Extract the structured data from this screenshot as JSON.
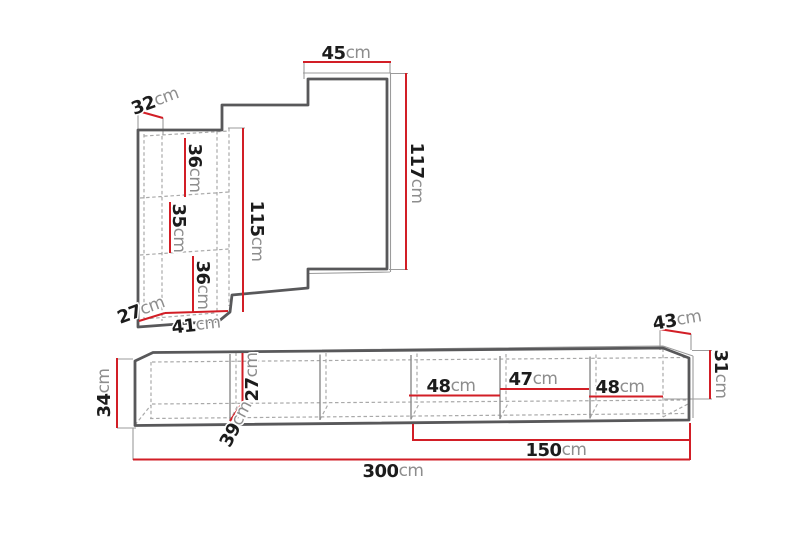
{
  "colors": {
    "dimension_red": "#d21e26",
    "outline_gray": "#58585a",
    "dashed_gray": "#a9a9a9",
    "background": "#ffffff"
  },
  "wall_unit": {
    "dims": {
      "d45": {
        "num": "45",
        "unit": "cm"
      },
      "d32": {
        "num": "32",
        "unit": "cm"
      },
      "d117": {
        "num": "117",
        "unit": "cm"
      },
      "d115": {
        "num": "115",
        "unit": "cm"
      },
      "d36_top": {
        "num": "36",
        "unit": "cm"
      },
      "d35": {
        "num": "35",
        "unit": "cm"
      },
      "d36_bottom": {
        "num": "36",
        "unit": "cm"
      },
      "d27": {
        "num": "27",
        "unit": "cm"
      },
      "d41": {
        "num": "41",
        "unit": "cm"
      }
    }
  },
  "bench": {
    "dims": {
      "d34": {
        "num": "34",
        "unit": "cm"
      },
      "d39": {
        "num": "39",
        "unit": "cm"
      },
      "d27": {
        "num": "27",
        "unit": "cm"
      },
      "d48_1": {
        "num": "48",
        "unit": "cm"
      },
      "d47": {
        "num": "47",
        "unit": "cm"
      },
      "d48_2": {
        "num": "48",
        "unit": "cm"
      },
      "d43": {
        "num": "43",
        "unit": "cm"
      },
      "d31": {
        "num": "31",
        "unit": "cm"
      },
      "d150": {
        "num": "150",
        "unit": "cm"
      },
      "d300": {
        "num": "300",
        "unit": "cm"
      }
    }
  }
}
